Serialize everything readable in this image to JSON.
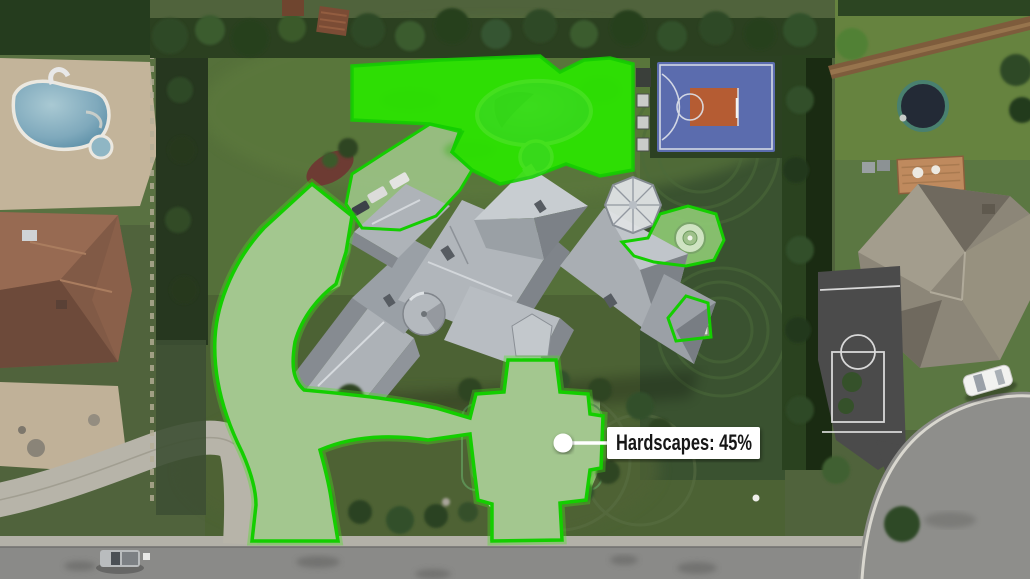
{
  "annotation": {
    "label": "Hardscapes: 45%",
    "metric": "Hardscapes",
    "value": "45%"
  },
  "overlay": {
    "stroke_color": "#14ce00",
    "fill_saturated": "#2ee004",
    "fill_washed": "#a3c78f"
  },
  "label_style": {
    "background": "#ffffff",
    "text_color": "#161616",
    "marker_color": "#ffffff"
  },
  "icons": {
    "marker": "point-marker-dot",
    "leader": "leader-line"
  }
}
